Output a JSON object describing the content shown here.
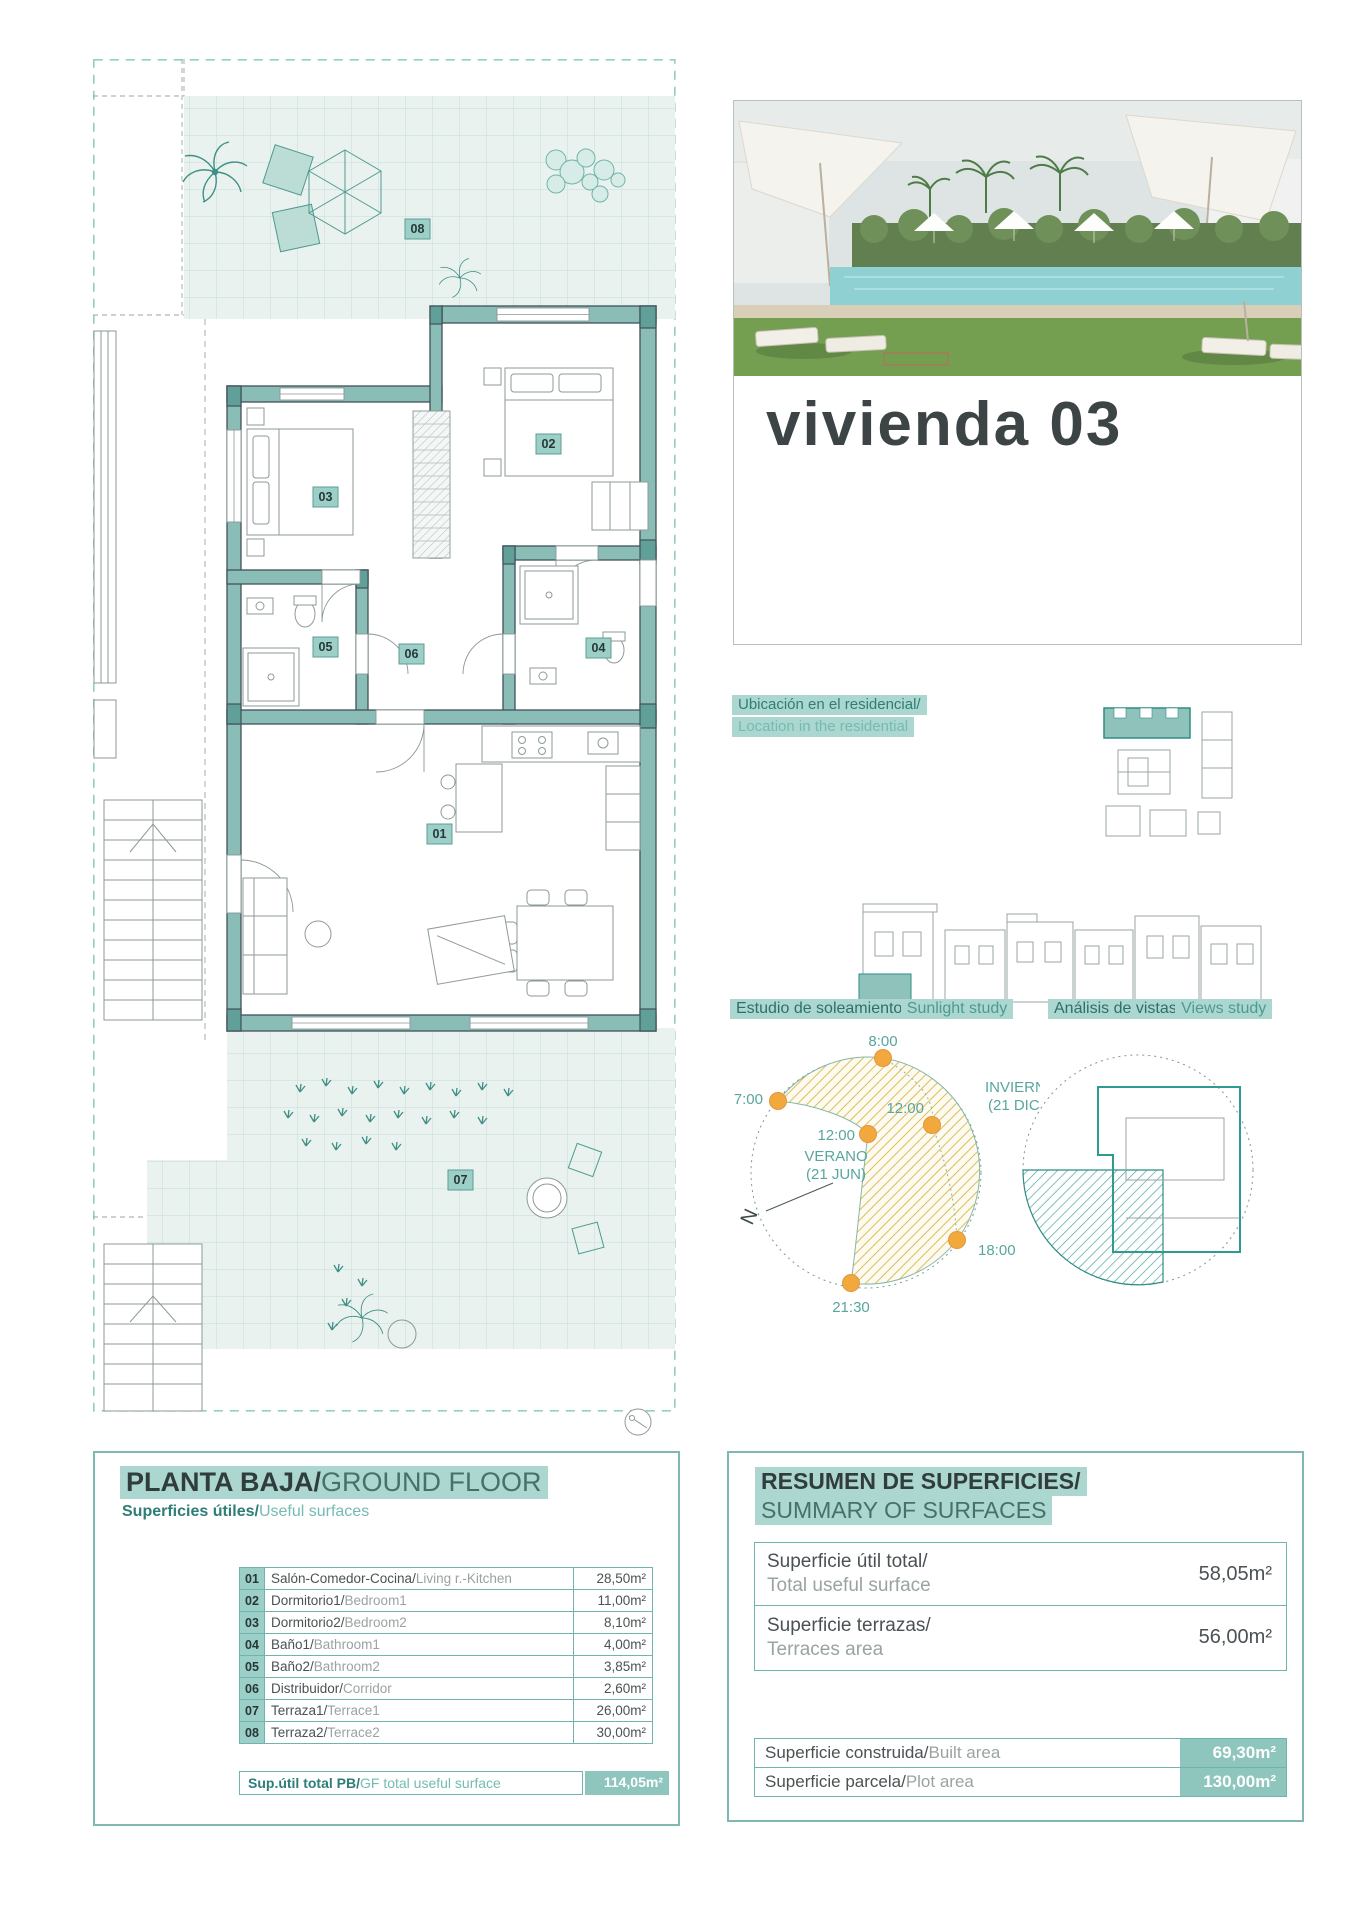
{
  "hero": {
    "title": "vivienda 03"
  },
  "location": {
    "line1": "Ubicación en el residencial/",
    "line2": "Location in the residential"
  },
  "sun": {
    "title_es": "Estudio de soleamiento/",
    "title_en": "Sunlight study",
    "h0700": "7:00",
    "h0800": "8:00",
    "h1200_summer": "12:00",
    "h1200_winter": "12:00",
    "h1800": "18:00",
    "h2130": "21:30",
    "summer_line1": "VERANO",
    "summer_line2": "(21 JUN)",
    "winter_line1": "INVIERNO",
    "winter_line2": "(21 DIC)",
    "north": "N"
  },
  "views": {
    "title_es": "Análisis de vistas/",
    "title_en": "Views study"
  },
  "plan": {
    "badges": [
      "01",
      "02",
      "03",
      "04",
      "05",
      "06",
      "07",
      "08"
    ]
  },
  "ground_floor": {
    "title_es": "PLANTA BAJA/",
    "title_en": "GROUND FLOOR",
    "subtitle_es": "Superficies útiles/",
    "subtitle_en": "Useful surfaces",
    "rows": [
      {
        "num": "01",
        "es": "Salón-Comedor-Cocina/",
        "en": "Living r.-Kitchen",
        "value": "28,50m²"
      },
      {
        "num": "02",
        "es": "Dormitorio1/",
        "en": "Bedroom1",
        "value": "11,00m²"
      },
      {
        "num": "03",
        "es": "Dormitorio2/",
        "en": "Bedroom2",
        "value": "8,10m²"
      },
      {
        "num": "04",
        "es": "Baño1/",
        "en": "Bathroom1",
        "value": "4,00m²"
      },
      {
        "num": "05",
        "es": "Baño2/",
        "en": "Bathroom2",
        "value": "3,85m²"
      },
      {
        "num": "06",
        "es": "Distribuidor/",
        "en": "Corridor",
        "value": "2,60m²"
      },
      {
        "num": "07",
        "es": "Terraza1/",
        "en": "Terrace1",
        "value": "26,00m²"
      },
      {
        "num": "08",
        "es": "Terraza2/",
        "en": "Terrace2",
        "value": "30,00m²"
      }
    ],
    "total_es": "Sup.útil total PB/",
    "total_en": "GF total useful surface",
    "total_value": "114,05m²"
  },
  "summary": {
    "title_es": "RESUMEN DE SUPERFICIES/",
    "title_en": "SUMMARY OF SURFACES",
    "rows": [
      {
        "es": "Superficie útil total/",
        "en": "Total useful surface",
        "value": "58,05m²"
      },
      {
        "es": "Superficie terrazas/",
        "en": "Terraces area",
        "value": "56,00m²"
      }
    ],
    "rows_built": [
      {
        "es": "Superficie construida/",
        "en": "Built area",
        "value": "69,30m²"
      },
      {
        "es": "Superficie parcela/",
        "en": "Plot area",
        "value": "130,00m²"
      }
    ]
  },
  "colors": {
    "accent": "#2e7d76",
    "highlight": "#abd7d0",
    "wall": "#8abdb6",
    "sun": "#f1a83c"
  }
}
